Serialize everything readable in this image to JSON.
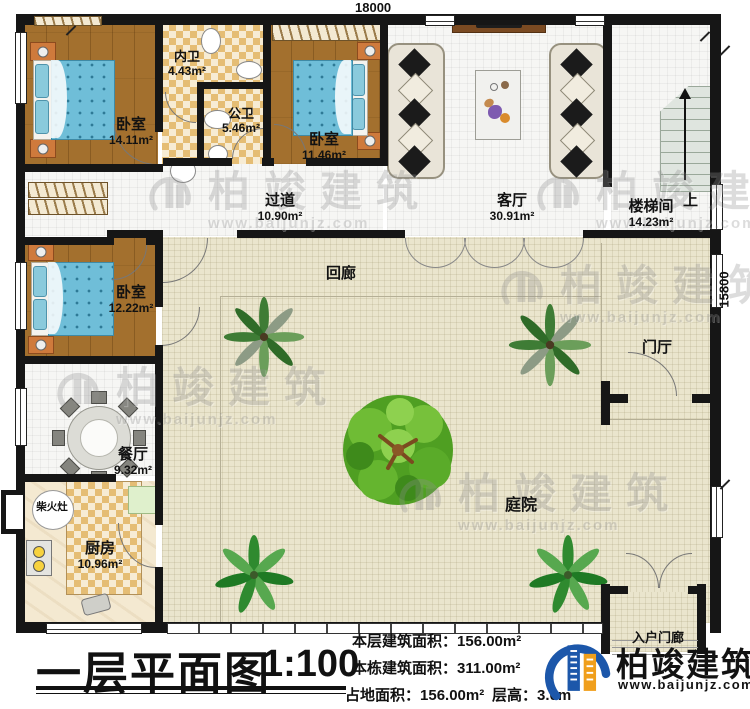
{
  "plan": {
    "dim_top": "18000",
    "dim_right": "15800",
    "up": "上",
    "rooms": {
      "bedroom1": {
        "name": "卧室",
        "area": "14.11m²"
      },
      "bath_inner": {
        "name": "内卫",
        "area": "4.43m²"
      },
      "bath_public": {
        "name": "公卫",
        "area": "5.46m²"
      },
      "bedroom2": {
        "name": "卧室",
        "area": "11.46m²"
      },
      "living": {
        "name": "客厅",
        "area": "30.91m²"
      },
      "stairwell": {
        "name": "楼梯间",
        "area": "14.23m²"
      },
      "hallway": {
        "name": "过道",
        "area": "10.90m²"
      },
      "bedroom3": {
        "name": "卧室",
        "area": "12.22m²"
      },
      "cloister": {
        "name": "回廊"
      },
      "dining": {
        "name": "餐厅",
        "area": "9.32m²"
      },
      "wood_stove": {
        "name": "柴火灶"
      },
      "kitchen": {
        "name": "厨房",
        "area": "10.96m²"
      },
      "courtyard": {
        "name": "庭院"
      },
      "foyer": {
        "name": "门厅"
      },
      "entry_porch": {
        "name": "入户门廊"
      }
    }
  },
  "titleblock": {
    "title": "一层平面图",
    "scale": "1:100"
  },
  "stats": {
    "floor_area_label": "本层建筑面积：",
    "floor_area": "156.00m²",
    "building_area_label": "本栋建筑面积：",
    "building_area": "311.00m²",
    "footprint_label": "占地面积：",
    "footprint": "156.00m²",
    "height_label": "层高：",
    "height": "3.0m"
  },
  "brand": {
    "name": "柏竣建筑",
    "site": "www.baijunjz.com"
  },
  "watermark": {
    "name": "柏竣建筑",
    "site": "www.baijunjz.com"
  },
  "colors": {
    "wall": "#161616",
    "bed": "#6fbed8",
    "wood_floor": "#a3702e",
    "courtyard": "#eae5cd",
    "brand_blue": "#1c57aa",
    "brand_orange": "#f09f1c"
  }
}
